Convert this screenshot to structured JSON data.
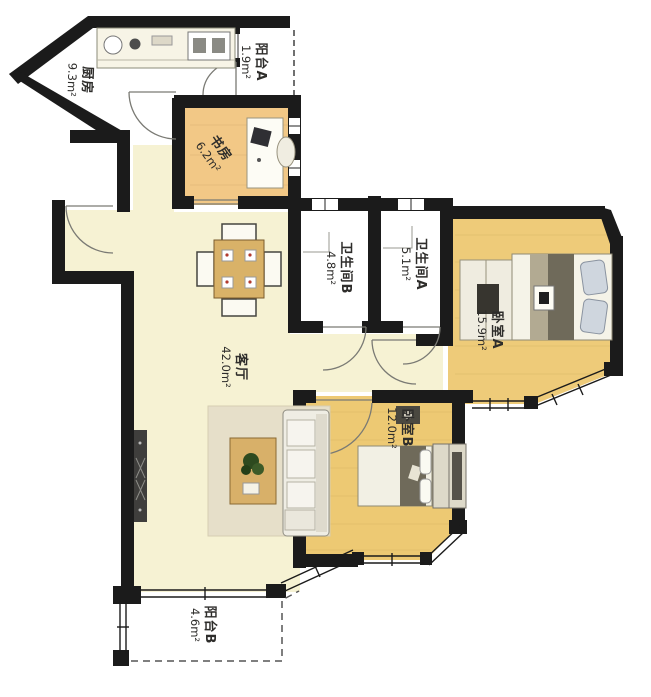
{
  "plan": {
    "type": "apartment-floor-plan",
    "rooms": [
      {
        "id": "kitchen",
        "name": "厨房",
        "area": "9.3m²"
      },
      {
        "id": "balcony-a",
        "name": "阳台A",
        "area": "1.9m²"
      },
      {
        "id": "study",
        "name": "书房",
        "area": "6.2m²"
      },
      {
        "id": "bathroom-b",
        "name": "卫生间B",
        "area": "4.8m²"
      },
      {
        "id": "bathroom-a",
        "name": "卫生间A",
        "area": "5.1m²"
      },
      {
        "id": "bedroom-a",
        "name": "卧室A",
        "area": "15.9m²"
      },
      {
        "id": "living-room",
        "name": "客厅",
        "area": "42.0m²"
      },
      {
        "id": "bedroom-b",
        "name": "卧室B",
        "area": "12.0m²"
      },
      {
        "id": "balcony-b",
        "name": "阳台B",
        "area": "4.6m²"
      }
    ],
    "colors": {
      "wall": "#1b1b1b",
      "living_floor": "#f6f2d3",
      "study_floor": "#f2c886",
      "bedroom_floor": "#eecb79",
      "white_floor": "#ffffff"
    }
  }
}
